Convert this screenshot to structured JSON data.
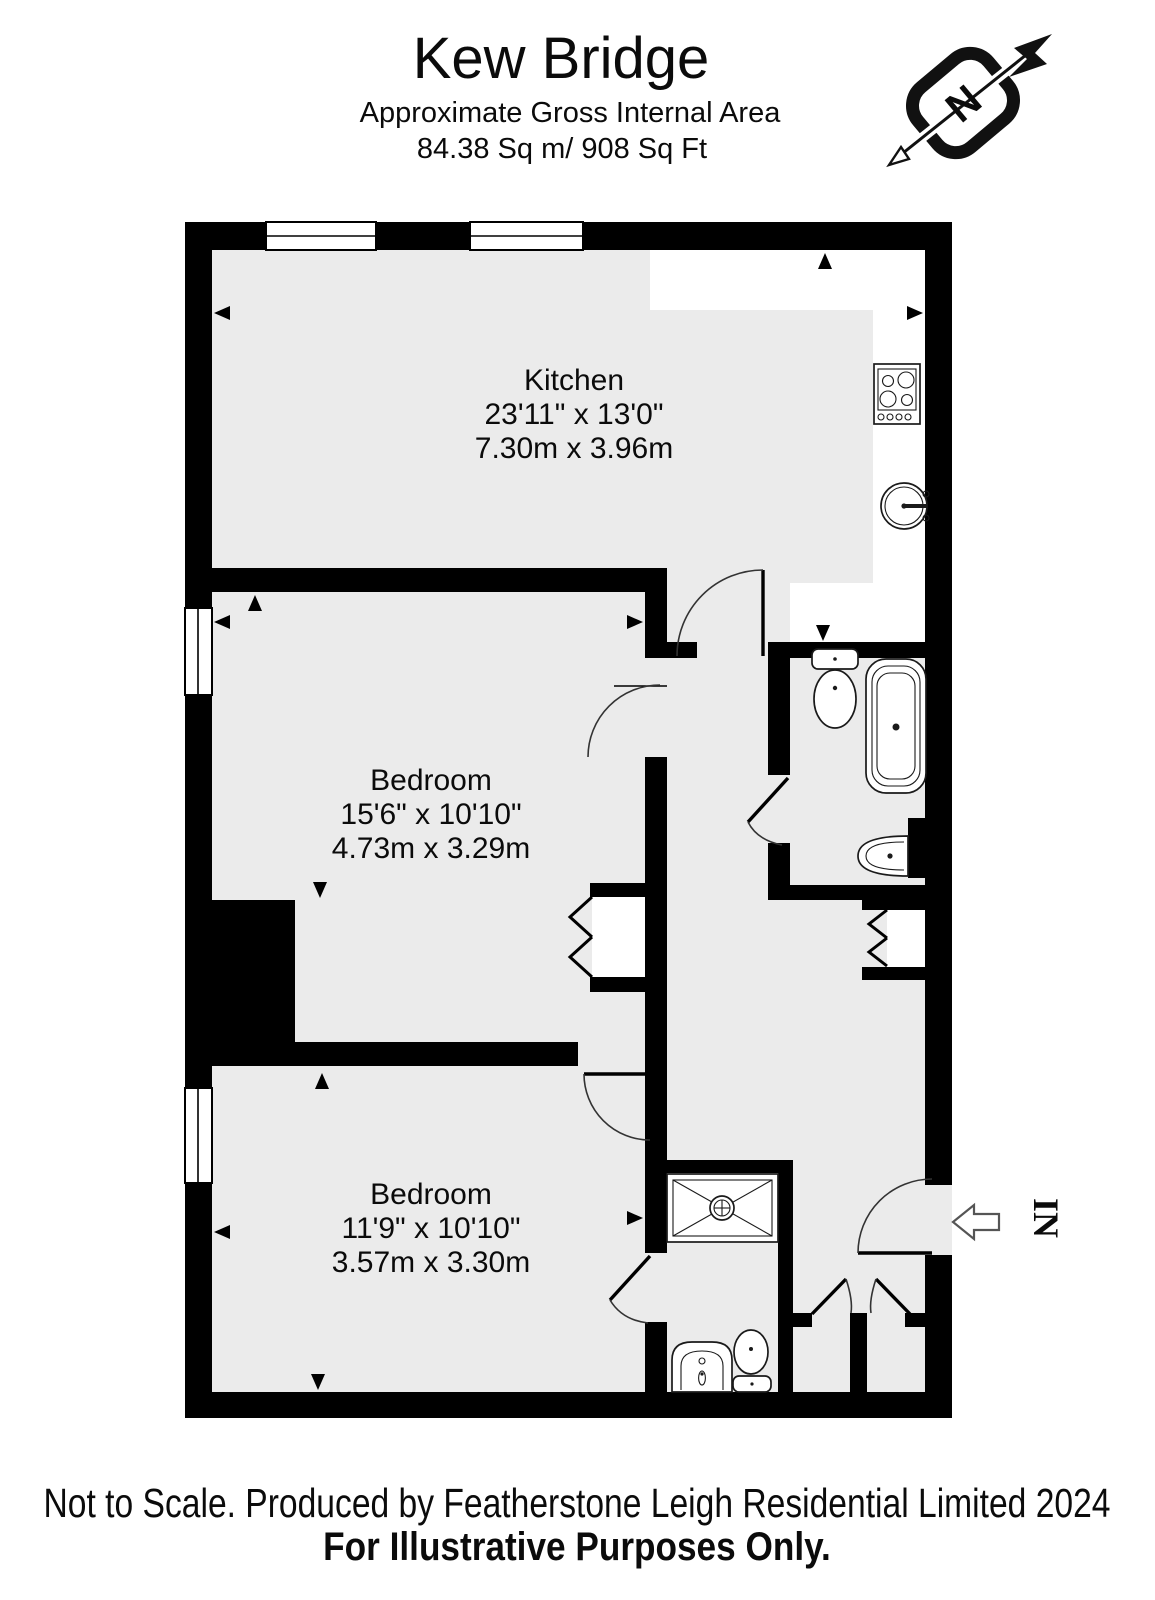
{
  "header": {
    "title": "Kew Bridge",
    "subtitle_line1": "Approximate Gross Internal Area",
    "subtitle_line2": "84.38 Sq m/ 908 Sq Ft"
  },
  "compass": {
    "label": "N"
  },
  "plan": {
    "rooms": {
      "kitchen": {
        "name": "Kitchen",
        "dims_imperial": "23'11\" x 13'0\"",
        "dims_metric": "7.30m x 3.96m"
      },
      "bedroom1": {
        "name": "Bedroom",
        "dims_imperial": "15'6\" x 10'10\"",
        "dims_metric": "4.73m x 3.29m"
      },
      "bedroom2": {
        "name": "Bedroom",
        "dims_imperial": "11'9\" x 10'10\"",
        "dims_metric": "3.57m x 3.30m"
      }
    },
    "entrance_label": "IN",
    "fixtures": {
      "kitchen": [
        "hob",
        "sink"
      ],
      "bathroom": [
        "toilet",
        "bathtub",
        "wash-basin"
      ],
      "shower_room": [
        "shower-tray",
        "wash-basin",
        "toilet"
      ]
    },
    "colors": {
      "wall": "#000000",
      "floor": "#ebebeb",
      "background": "#ffffff"
    }
  },
  "footer": {
    "line1": "Not to Scale. Produced by Featherstone Leigh Residential Limited 2024",
    "line2": "For Illustrative Purposes Only."
  }
}
